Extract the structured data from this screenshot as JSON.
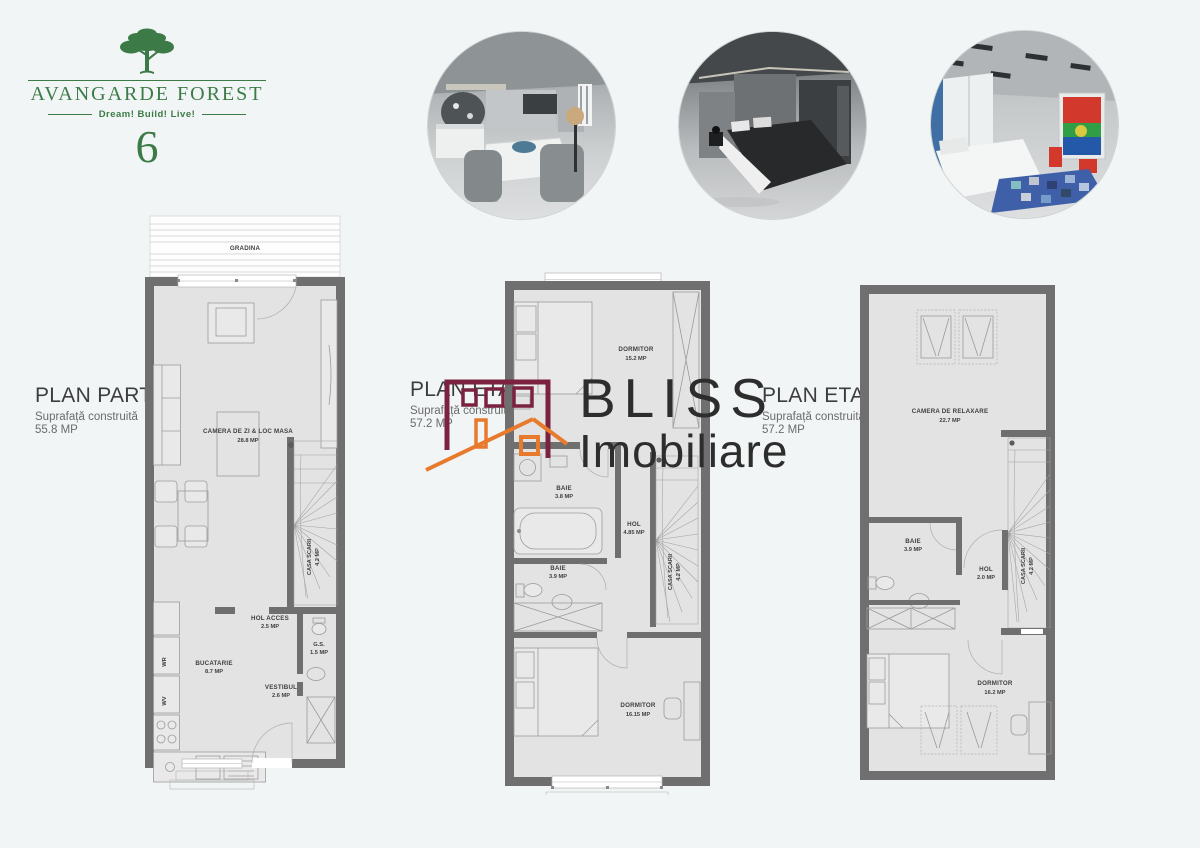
{
  "logo": {
    "title": "AVANGARDE FOREST",
    "tagline": "Dream! Build! Live!",
    "number": "6",
    "green": "#3c7b47"
  },
  "photos": [
    {
      "name": "living-dining-render"
    },
    {
      "name": "bedroom-render"
    },
    {
      "name": "kids-room-render"
    }
  ],
  "watermark": {
    "line1": "BLISS",
    "line2": "Imobiliare",
    "building_color": "#7b2240",
    "roof_color": "#e87a2e"
  },
  "plans": [
    {
      "title": "PLAN PARTER",
      "subtitle": "Suprafață construită",
      "area": "55.8 MP",
      "rooms": [
        {
          "label": "GRADINA",
          "area": ""
        },
        {
          "label": "CAMERA DE ZI & LOC MASA",
          "area": "28.8 MP"
        },
        {
          "label": "CASA SCARII",
          "area": "4.2 MP"
        },
        {
          "label": "HOL ACCES",
          "area": "2.5 MP"
        },
        {
          "label": "G.S.",
          "area": "1.5 MP"
        },
        {
          "label": "BUCATARIE",
          "area": "8.7 MP"
        },
        {
          "label": "VESTIBUL",
          "area": "2.6 MP"
        }
      ],
      "appliances": [
        "WR",
        "WV"
      ]
    },
    {
      "title": "PLAN ETAJ 1",
      "subtitle": "Suprafață construită",
      "area": "57.2 MP",
      "rooms": [
        {
          "label": "DORMITOR",
          "area": "15.2 MP"
        },
        {
          "label": "BAIE",
          "area": "3.8 MP"
        },
        {
          "label": "HOL",
          "area": "4.85 MP"
        },
        {
          "label": "CASA SCARII",
          "area": "4.2 MP"
        },
        {
          "label": "BAIE",
          "area": "3.9 MP"
        },
        {
          "label": "DORMITOR",
          "area": "16.15 MP"
        }
      ]
    },
    {
      "title": "PLAN ETAJ 2",
      "subtitle": "Suprafață construită",
      "area": "57.2 MP",
      "rooms": [
        {
          "label": "CAMERA DE RELAXARE",
          "area": "22.7 MP"
        },
        {
          "label": "CASA SCARII",
          "area": "4.2 MP"
        },
        {
          "label": "BAIE",
          "area": "3.9 MP"
        },
        {
          "label": "HOL",
          "area": "2.0 MP"
        },
        {
          "label": "DORMITOR",
          "area": "16.2 MP"
        }
      ]
    }
  ]
}
